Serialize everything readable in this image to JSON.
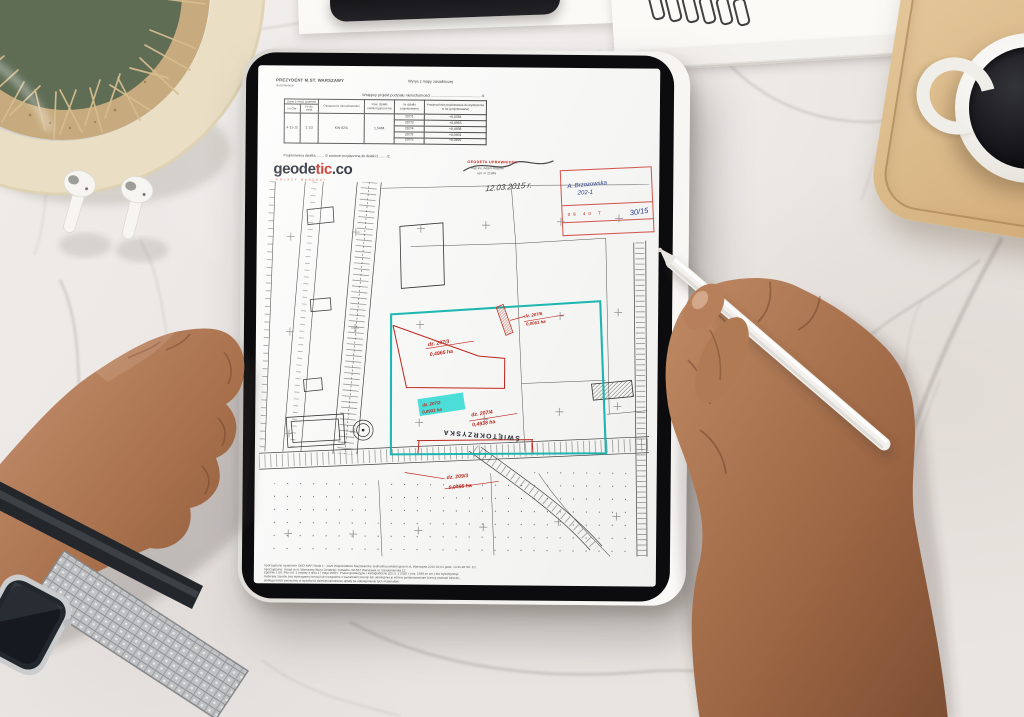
{
  "colors": {
    "annotation_red": "#c2281e",
    "boundary_cyan": "#14b8b2",
    "highlight_cyan": "#43e2dc",
    "ink_blue": "#2b3f9b",
    "logo_red": "#d02b22",
    "tray_wood": "#d8b88b"
  },
  "document": {
    "issuer": "PREZYDENT M.ST. WARSZAWY",
    "issuer_sub": "Śródmieście",
    "doc_type": "Wyrys z mapy zasadniczej",
    "title": "Wstępny projekt podziału nieruchomości ............................................... 4",
    "note": "Projektowana działka ........ /2 zostanie przyłączona do działki 2 ....... /2.",
    "table": {
      "headers": {
        "dane": "Dane z ewid. gruntów",
        "nr_obr": "Nr Obr.",
        "nr_dz": "Nr dz. ewid.",
        "oznaczenie": "Oznaczenie nieruchomości",
        "pow": "Pow. działki ewidencyjnej w ha",
        "nr_proj": "Nr działki projektowanej",
        "pow_proj": "Powierzchnia projektowana do wydzielenia w ha (projektowana)"
      },
      "row": {
        "nr_obr": "4-11-15",
        "nr_dz": "2 1/2",
        "oznaczenie": "KW 82/6",
        "pow": "1,5484"
      },
      "proj": [
        {
          "nr": "207/1",
          "pow": "+0,0581"
        },
        {
          "nr": "207/3",
          "pow": "+0,4965"
        },
        {
          "nr": "207/4",
          "pow": "+0,4938"
        },
        {
          "nr": "207/2",
          "pow": "+0,0931"
        },
        {
          "nr": "207/5",
          "pow": "+0,0495"
        }
      ]
    },
    "logo": {
      "part1": "geode",
      "part2": "tic",
      "part3": ".co",
      "tagline": "POLSCY GEODECI"
    },
    "signature": {
      "heading": "GEODETA UPRAWNIONY",
      "name": "mgr inż. Adam Różycki",
      "number": "upr. nr 21345",
      "date": "12.03.2015 r."
    },
    "corner_stamp": {
      "line1": "A. Brzozowska",
      "line2": "202-1",
      "cells": "08  40  T",
      "note": "30/15"
    },
    "map": {
      "labels": {
        "p1n": "dz. 207/3",
        "p1a": "0,4965 ha",
        "p2n": "dz. 207/4",
        "p2a": "0,4938 ha",
        "p3n": "dz. 207/2",
        "p3a": "0,0931 ha",
        "p4n": "dz. 207/6",
        "p4a": "0,0061 ha",
        "p5n": "dz. 209/3",
        "p5a": "0,0495 ha",
        "street": "ŚWIĘTOKRZYSKA"
      }
    },
    "fine_print": {
      "l1": "Sporządzono systemem GEO-MAP   Skala 1 : 1029   Województwo Mazowieckie   Jednostka ewidencyjna m.st. Warszawa   2015-03-01 godz. 13:41:26   Str. 1/1",
      "l2": "Sporządzono: Urząd m.st. Warszawy Biuro Geodezji i Katastru, 00-557 Warszawa ul. Sandomierska 12",
      "l3": "Zgodnie z art. 48a ust. 1 ustawy z dnia 17 maja 1989 r. Prawo geodezyjne i kartograficzne (Dz.U. z 2010 r. poz. 1939 ze zm.) kto wykorzystuje",
      "l4": "materiały zasobu bez wymaganej licencji lub niezgodnie z warunkami licencji lub udostępnia je wbrew postanowieniom licencji osobom trzecim,",
      "l5": "podlega karze pieniężnej w wysokości dziesięciokrotności opłaty za udostępnienie tych materiałów."
    }
  }
}
